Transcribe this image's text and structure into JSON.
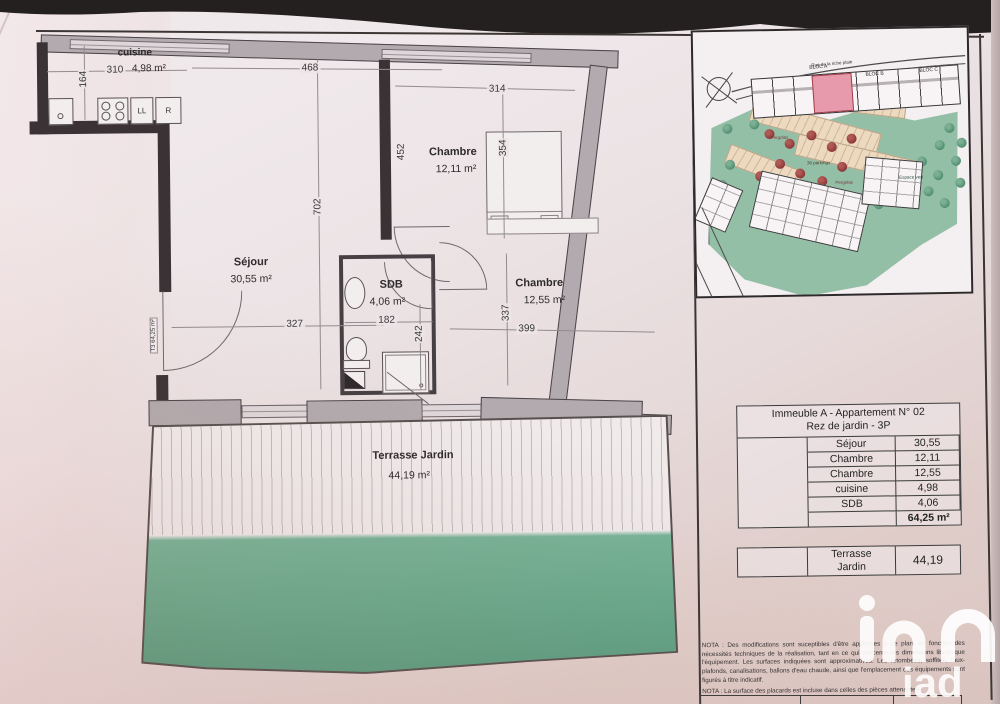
{
  "floorplan": {
    "entrance_label": "T3 64,25 m²",
    "rooms": {
      "cuisine": {
        "name": "cuisine",
        "area": "4,98 m²"
      },
      "chambre1": {
        "name": "Chambre",
        "area": "12,11 m²"
      },
      "sejour": {
        "name": "Séjour",
        "area": "30,55 m²"
      },
      "sdb": {
        "name": "SDB",
        "area": "4,06 m²"
      },
      "chambre2": {
        "name": "Chambre",
        "area": "12,55 m²"
      },
      "terrasse": {
        "name": "Terrasse Jardin",
        "area": "44,19 m²"
      }
    },
    "dims": {
      "d310": "310",
      "d164": "164",
      "d468": "468",
      "d314": "314",
      "d452": "452",
      "d354": "354",
      "d702": "702",
      "d327": "327",
      "d182": "182",
      "d242": "242",
      "d337": "337",
      "d399": "399"
    },
    "appliances": {
      "ll": "LL",
      "r": "R"
    }
  },
  "site_plan": {
    "street": "Rue de la riche plaie",
    "blocks": [
      "BLOC A",
      "BLOC B",
      "BLOC C"
    ],
    "labels": {
      "parkings": "36 parkings",
      "pergolas": "Pergolas",
      "espace_vert": "Espace vert"
    }
  },
  "area_table": {
    "title_line1": "Immeuble A - Appartement N° 02",
    "title_line2": "Rez de jardin - 3P",
    "rows": [
      {
        "label": "Séjour",
        "value": "30,55"
      },
      {
        "label": "Chambre",
        "value": "12,11"
      },
      {
        "label": "Chambre",
        "value": "12,55"
      },
      {
        "label": "cuisine",
        "value": "4,98"
      },
      {
        "label": "SDB",
        "value": "4,06"
      }
    ],
    "total": "64,25 m²"
  },
  "terrace_table": {
    "label_line1": "Terrasse",
    "label_line2": "Jardin",
    "value": "44,19"
  },
  "nota": {
    "p1": "NOTA : Des modifications sont suceptibles d'être apportées à ce plan, en fonction des nécessités techniques de la réalisation, tant en ce qui concerne les dimensions libres que l'équipement. Les surfaces indiquées sont approximatives. Les retombées, soffites, faux-plafonds, canalisations, ballons d'eau chaude, ainsi que l'emplacement des équipements sont figurés à titre indicatif.",
    "p2": "NOTA : La surface des placards est incluse dans celles des pièces attenantes"
  },
  "watermark": {
    "brand": "iad"
  },
  "colors": {
    "terrace_green": "#68a98c",
    "garden_green": "#93bfa7",
    "highlight_unit": "#e79aab",
    "wall_dark": "#3a3235",
    "wall_gray": "#b2aaae"
  }
}
